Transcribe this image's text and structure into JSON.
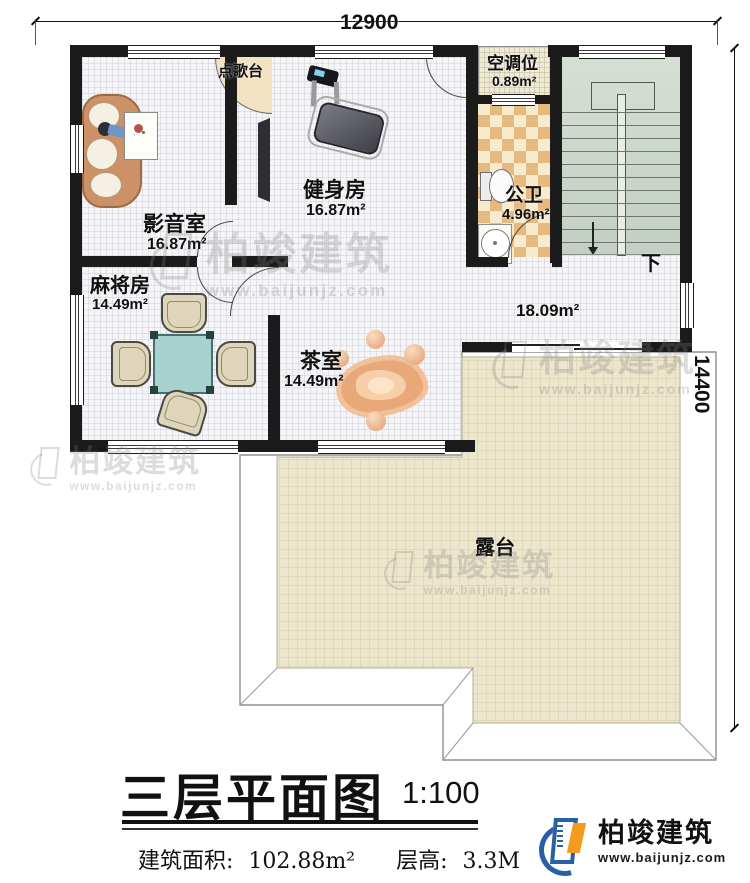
{
  "dimensions": {
    "width_mm": "12900",
    "height_mm": "14400"
  },
  "rooms": {
    "media": {
      "name": "影音室",
      "area": "16.87m²"
    },
    "gym": {
      "name": "健身房",
      "area": "16.87m²"
    },
    "karaoke": {
      "name": "点歌台"
    },
    "ac": {
      "name": "空调位",
      "area": "0.89m²"
    },
    "bath": {
      "name": "公卫",
      "area": "4.96m²"
    },
    "mahjong": {
      "name": "麻将房",
      "area": "14.49m²"
    },
    "tea": {
      "name": "茶室",
      "area": "14.49m²"
    },
    "hall": {
      "area": "18.09m²"
    },
    "terrace": {
      "name": "露台"
    },
    "stairs": {
      "down_label": "下"
    }
  },
  "title": {
    "main": "三层平面图",
    "scale": "1:100",
    "area_label": "建筑面积:",
    "area_value": "102.88m²",
    "floor_height_label": "层高:",
    "floor_height_value": "3.3M"
  },
  "brand": {
    "name": "柏竣建筑",
    "website": "www.baijunjz.com"
  },
  "watermark": {
    "name": "柏竣建筑",
    "website": "www.baijunjz.com"
  },
  "colors": {
    "wall": "#1b1b1b",
    "terrace_floor": "#ece6cd",
    "bath_tile": "#e6b97e",
    "stairs_floor": "#ccd7cb",
    "brand_blue": "#2b5fa5",
    "brand_orange": "#f29b1d"
  }
}
